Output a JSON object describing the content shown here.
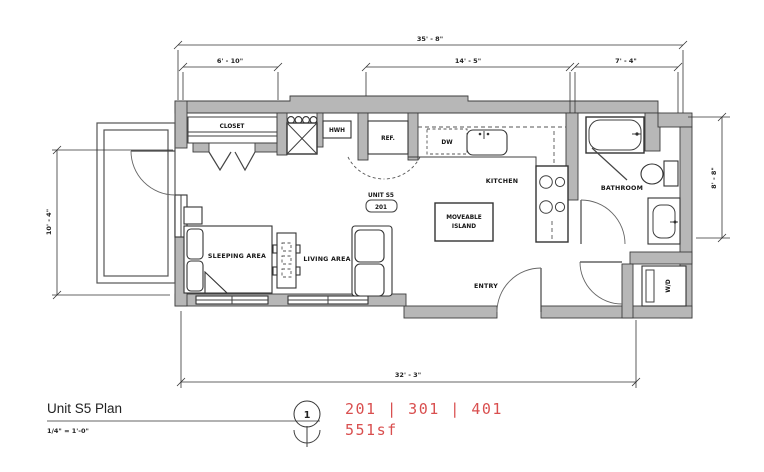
{
  "labels": {
    "closet": "CLOSET",
    "hwh": "HWH",
    "ref": "REF.",
    "dw": "DW",
    "kitchen": "KITCHEN",
    "unit_name": "UNIT S5",
    "unit_number": "201",
    "island_line1": "MOVEABLE",
    "island_line2": "ISLAND",
    "bathroom": "BATHROOM",
    "entry": "ENTRY",
    "sleeping": "SLEEPING AREA",
    "living": "LIVING AREA",
    "wd": "W/D"
  },
  "dimensions": {
    "overall_width": "35' - 8\"",
    "closet_width": "6' - 10\"",
    "kitchen_width": "14' - 5\"",
    "bath_width": "7' - 4\"",
    "left_height": "10' - 4\"",
    "right_height": "8' - 8\"",
    "bottom_width": "32' - 3\""
  },
  "title_block": {
    "title": "Unit S5 Plan",
    "scale": "1/4\" = 1'-0\"",
    "detail_number": "1"
  },
  "callout": {
    "units": "201 | 301 | 401",
    "area": "551sf",
    "color": "#d94f4f"
  },
  "colors": {
    "wall_fill": "#b7b7b7",
    "line_color": "#3c3c3c"
  }
}
